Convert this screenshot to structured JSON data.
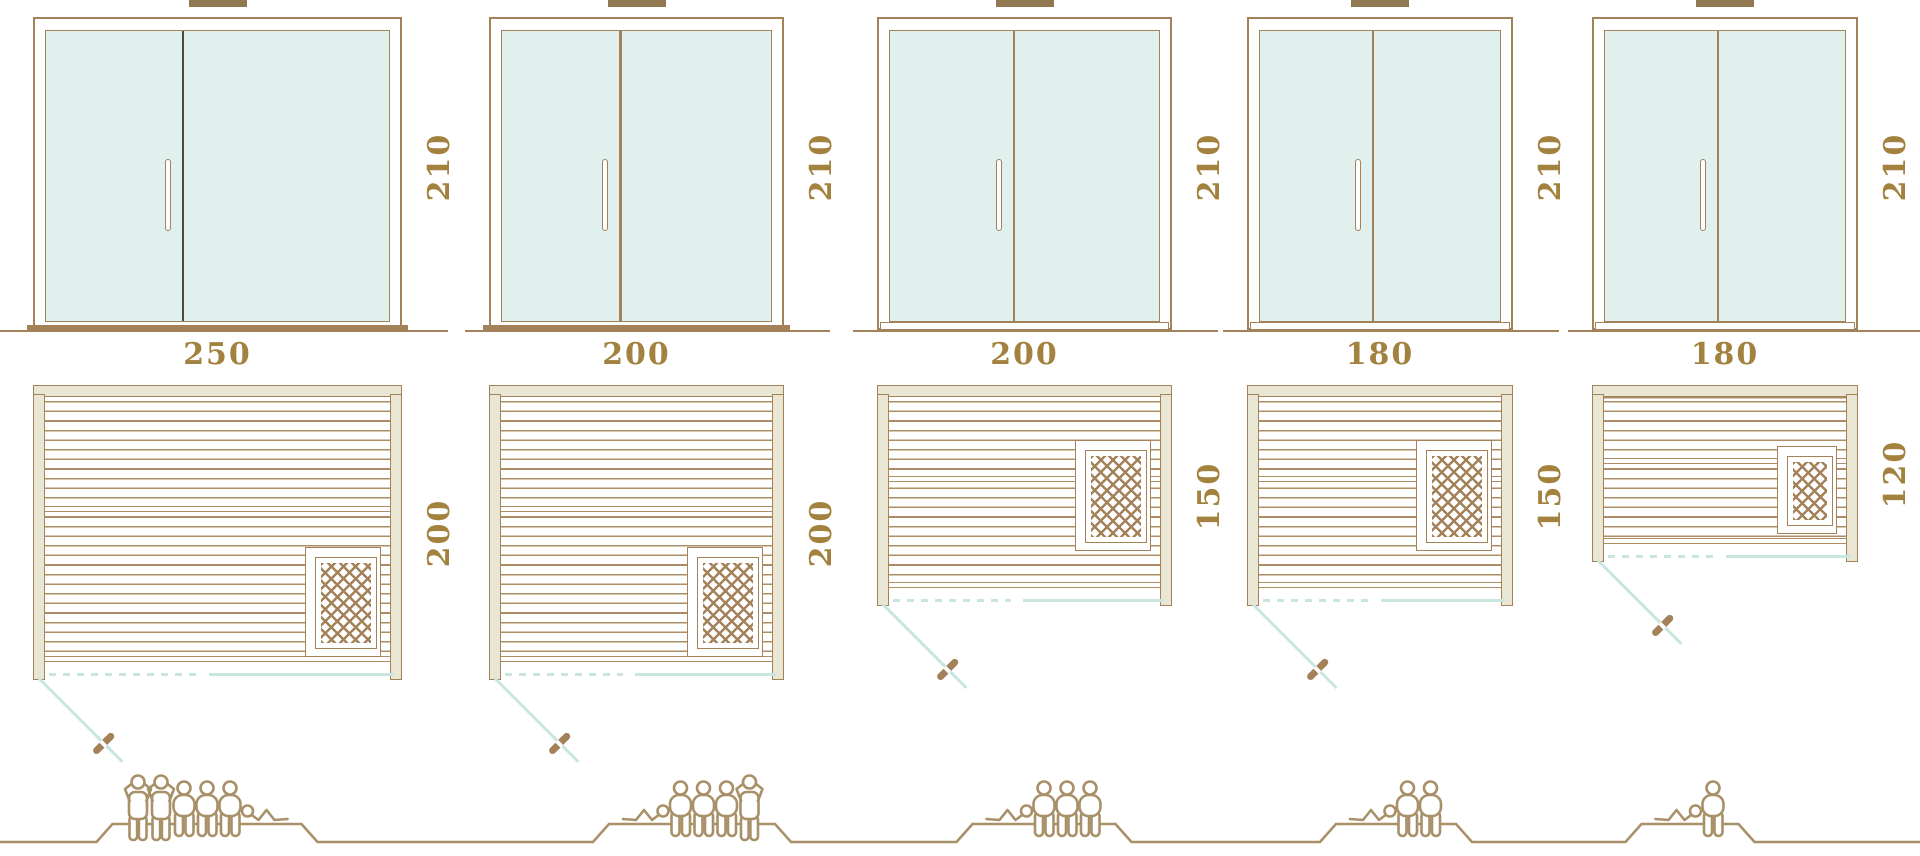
{
  "palette": {
    "background": "#ffffff",
    "line_brown": "#a3825a",
    "slat_brown": "#ad8d64",
    "frame_beige": "#e9e6d4",
    "glass_mint": "#dff0ed",
    "teal_accent": "#c9e5e0",
    "divider_dark": "#4f4a3e",
    "label_brown": "#a3813e",
    "people_brown": "#a89068",
    "vent_brown": "#927851"
  },
  "diagram": {
    "kind": "sauna-size-comparison",
    "views_per_column": [
      "door-front-elevation",
      "floor-plan-top-view",
      "capacity-figures"
    ]
  },
  "columns": [
    {
      "name": "sauna-250x200",
      "door": {
        "height_label": "210",
        "divider_frac": 0.4,
        "divider_dark": true,
        "threshold": "filled"
      },
      "plan": {
        "width_label": "250",
        "depth_label": "200"
      },
      "capacity": 6,
      "figures": [
        "standing",
        "standing",
        "seated",
        "seated",
        "seated",
        "lying"
      ],
      "lying_position": "right"
    },
    {
      "name": "sauna-200x200",
      "door": {
        "height_label": "210",
        "divider_frac": 0.44,
        "divider_dark": false,
        "threshold": "filled"
      },
      "plan": {
        "width_label": "200",
        "depth_label": "200"
      },
      "capacity": 5,
      "figures": [
        "lying",
        "seated",
        "seated",
        "seated",
        "standing"
      ],
      "lying_position": "left"
    },
    {
      "name": "sauna-200x150",
      "door": {
        "height_label": "210",
        "divider_frac": 0.46,
        "divider_dark": false,
        "threshold": "outlined"
      },
      "plan": {
        "width_label": "200",
        "depth_label": "150"
      },
      "capacity": 4,
      "figures": [
        "lying",
        "seated",
        "seated",
        "seated"
      ],
      "lying_position": "left"
    },
    {
      "name": "sauna-180x150",
      "door": {
        "height_label": "210",
        "divider_frac": 0.47,
        "divider_dark": false,
        "threshold": "outlined"
      },
      "plan": {
        "width_label": "180",
        "depth_label": "150"
      },
      "capacity": 3,
      "figures": [
        "lying",
        "seated",
        "seated"
      ],
      "lying_position": "left"
    },
    {
      "name": "sauna-180x120",
      "door": {
        "height_label": "210",
        "divider_frac": 0.47,
        "divider_dark": false,
        "threshold": "outlined"
      },
      "plan": {
        "width_label": "180",
        "depth_label": "120"
      },
      "capacity": 2,
      "figures": [
        "lying",
        "seated"
      ],
      "lying_position": "left"
    }
  ]
}
